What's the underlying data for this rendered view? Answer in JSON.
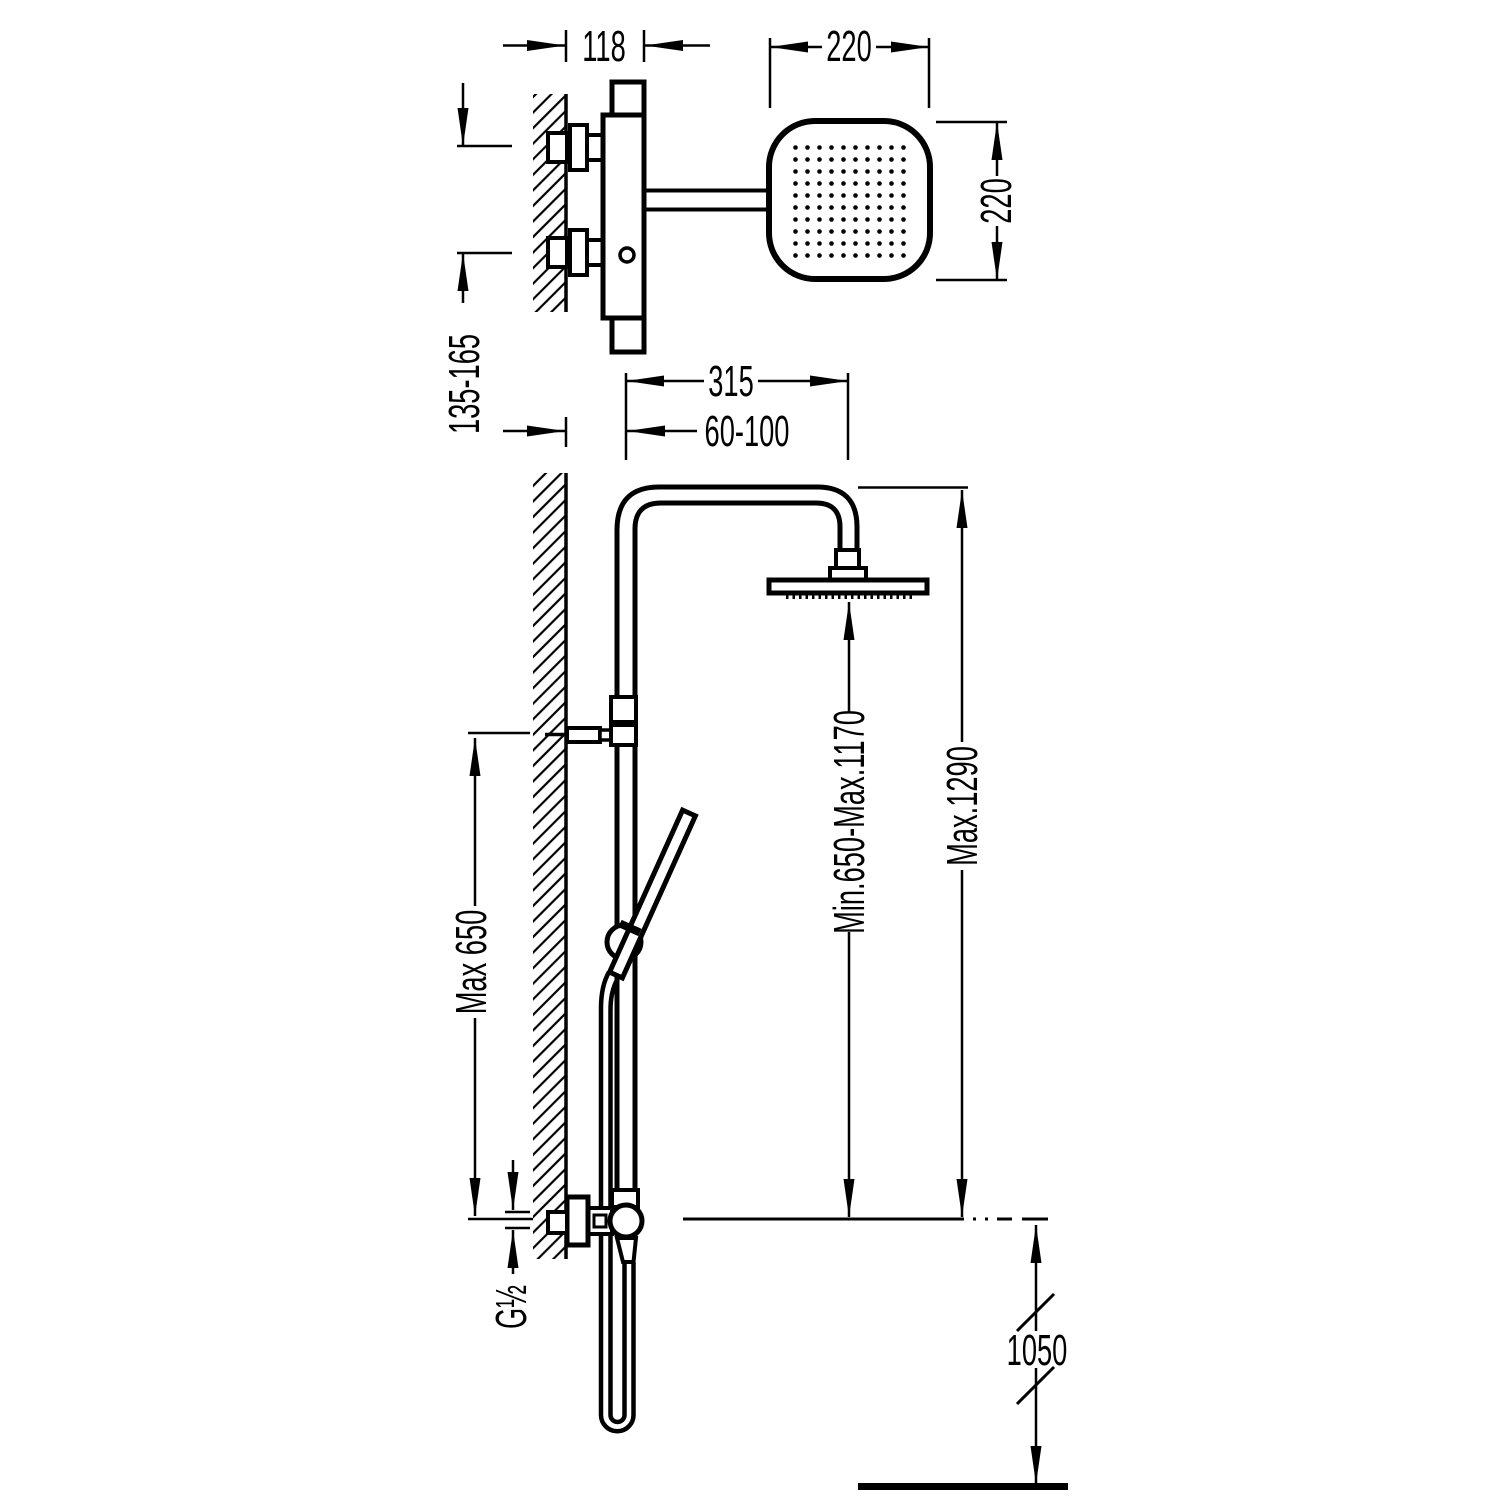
{
  "page": {
    "background": "#ffffff",
    "line_color": "#000000",
    "description": "Technical installation drawing of a thermostatic shower column with rain head and hand shower, side view (top) and front view (bottom), all dimensions in mm"
  },
  "dims": {
    "valve_depth": "118",
    "head_width": "220",
    "head_height": "220",
    "inlet_spacing": "135-165",
    "arm_projection": "315",
    "wall_to_riser": "60-100",
    "slide_bar_max": "Max 650",
    "rain_head_min_max": "Min.650-Max.1170",
    "column_max": "Max.1290",
    "thread_size": "G½",
    "base_height": "1050"
  }
}
